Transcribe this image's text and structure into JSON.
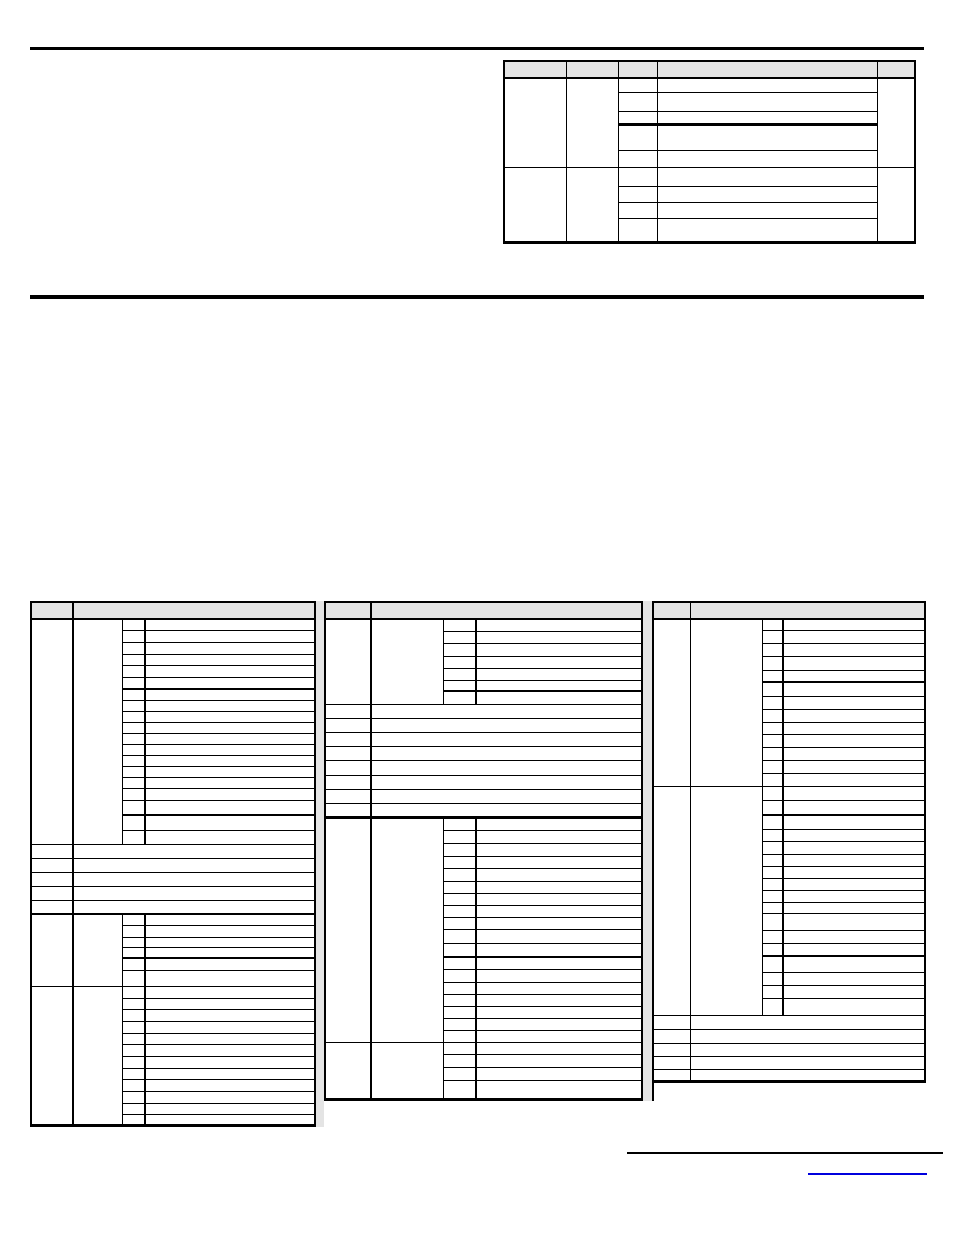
{
  "page": {
    "background": "#ffffff"
  },
  "colors": {
    "background": "#ffffff",
    "grid_line": "#000000",
    "header_fill": "#e4e4e4",
    "gutter_fill": "#e4e4e4",
    "rule": "#000000",
    "link_underline": "#0000dd"
  },
  "top_table": {
    "header_cells": [
      "",
      "",
      "",
      "",
      ""
    ],
    "visible_text": ""
  },
  "bottom_table": {
    "left_group_header_cells": [
      "",
      ""
    ],
    "middle_group_header_cells": [
      "",
      ""
    ],
    "right_group_header_cells": [
      "",
      ""
    ],
    "visible_text": ""
  },
  "footer": {
    "link_text": ""
  }
}
